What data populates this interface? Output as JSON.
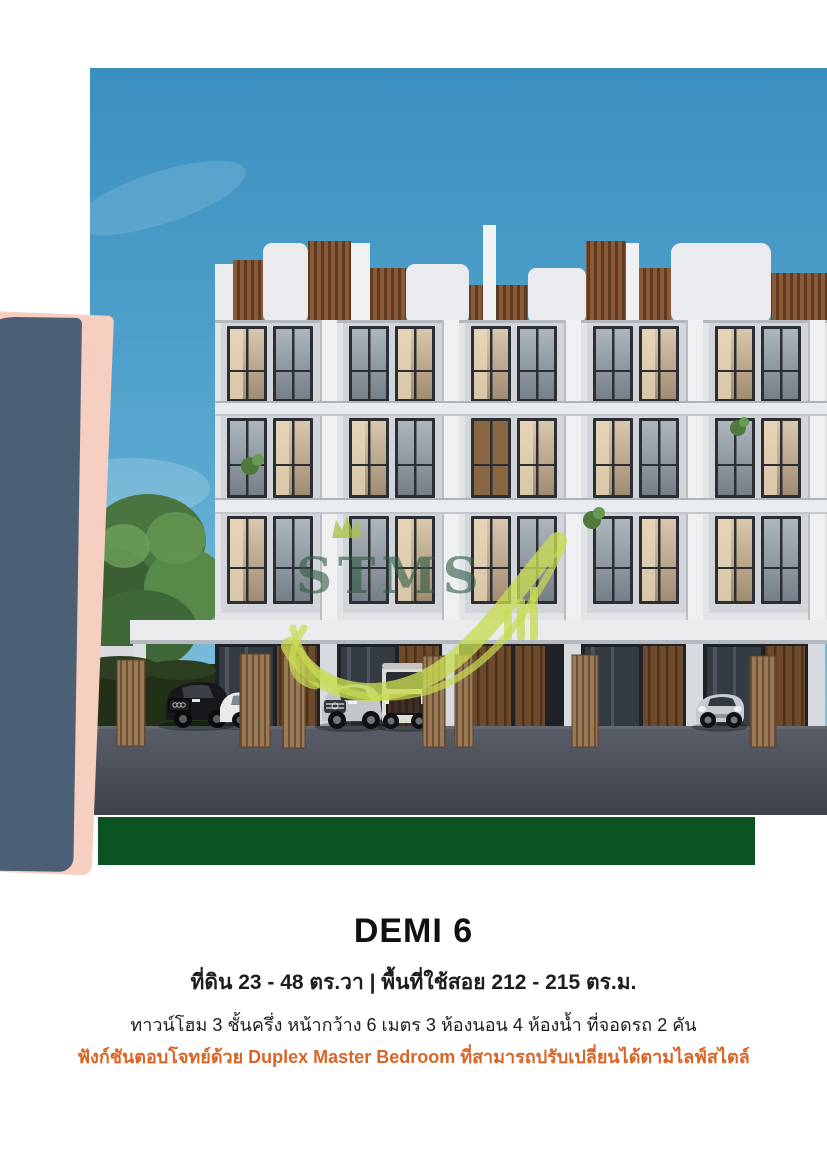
{
  "caption": {
    "title": "DEMI 6",
    "area_line": "ที่ดิน 23 - 48 ตร.วา  |  พื้นที่ใช้สอย 212 - 215 ตร.ม.",
    "spec_line": "ทาวน์โฮม 3 ชั้นครึ่ง หน้ากว้าง 6 เมตร 3 ห้องนอน 4 ห้องน้ำ ที่จอดรถ 2 คัน",
    "highlight_line": "ฟังก์ชันตอบโจทย์ด้วย Duplex Master Bedroom ที่สามารถปรับเปลี่ยนได้ตามไลฟ์สไตล์"
  },
  "watermark": {
    "text": "STMS"
  },
  "colors": {
    "title_text": "#111111",
    "body_text": "#1d1d1d",
    "highlight_text": "#d96526",
    "accent_pink": "#f7cfc0",
    "accent_navy": "#4b5f75",
    "accent_green": "#0a5220",
    "watermark_dark": "#2f5a45",
    "watermark_lime": "#c8dc52",
    "sky_top": "#3a90c0",
    "sky_bottom": "#84c2de",
    "facade_white": "#e2e5e8",
    "slat_brown": "#8a5a36",
    "road_gray": "#484d57"
  }
}
